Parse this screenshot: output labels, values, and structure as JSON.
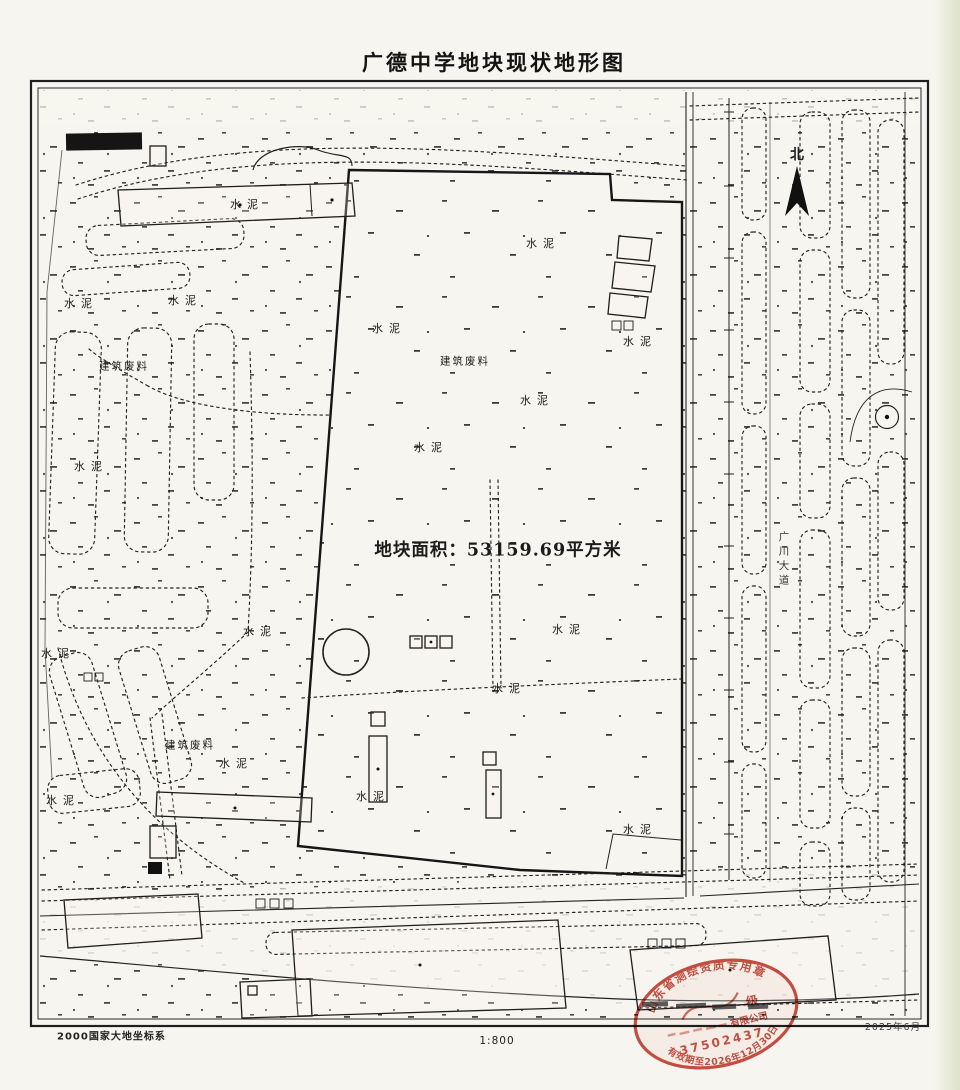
{
  "title": "广德中学地块现状地形图",
  "map": {
    "area_label": "地块面积：53159.69平方米",
    "north_label": "北",
    "road_label": "广川大道",
    "surface_labels": {
      "cement": "水泥",
      "construction_debris": "建筑废料"
    },
    "footer": {
      "coordinate_system": "2000国家大地坐标系",
      "scale": "1:800",
      "survey_date": "2025年6月"
    },
    "stamp": {
      "arc_top": "山东省测绘资质专用章",
      "grade": "级",
      "company_suffix": "有限公司",
      "number": "37502437",
      "valid_until": "有效期至2026年12月30日",
      "color": "#c0392b"
    },
    "ink_color": "#1f1f1f",
    "paper_color": "#f6f4ee"
  }
}
